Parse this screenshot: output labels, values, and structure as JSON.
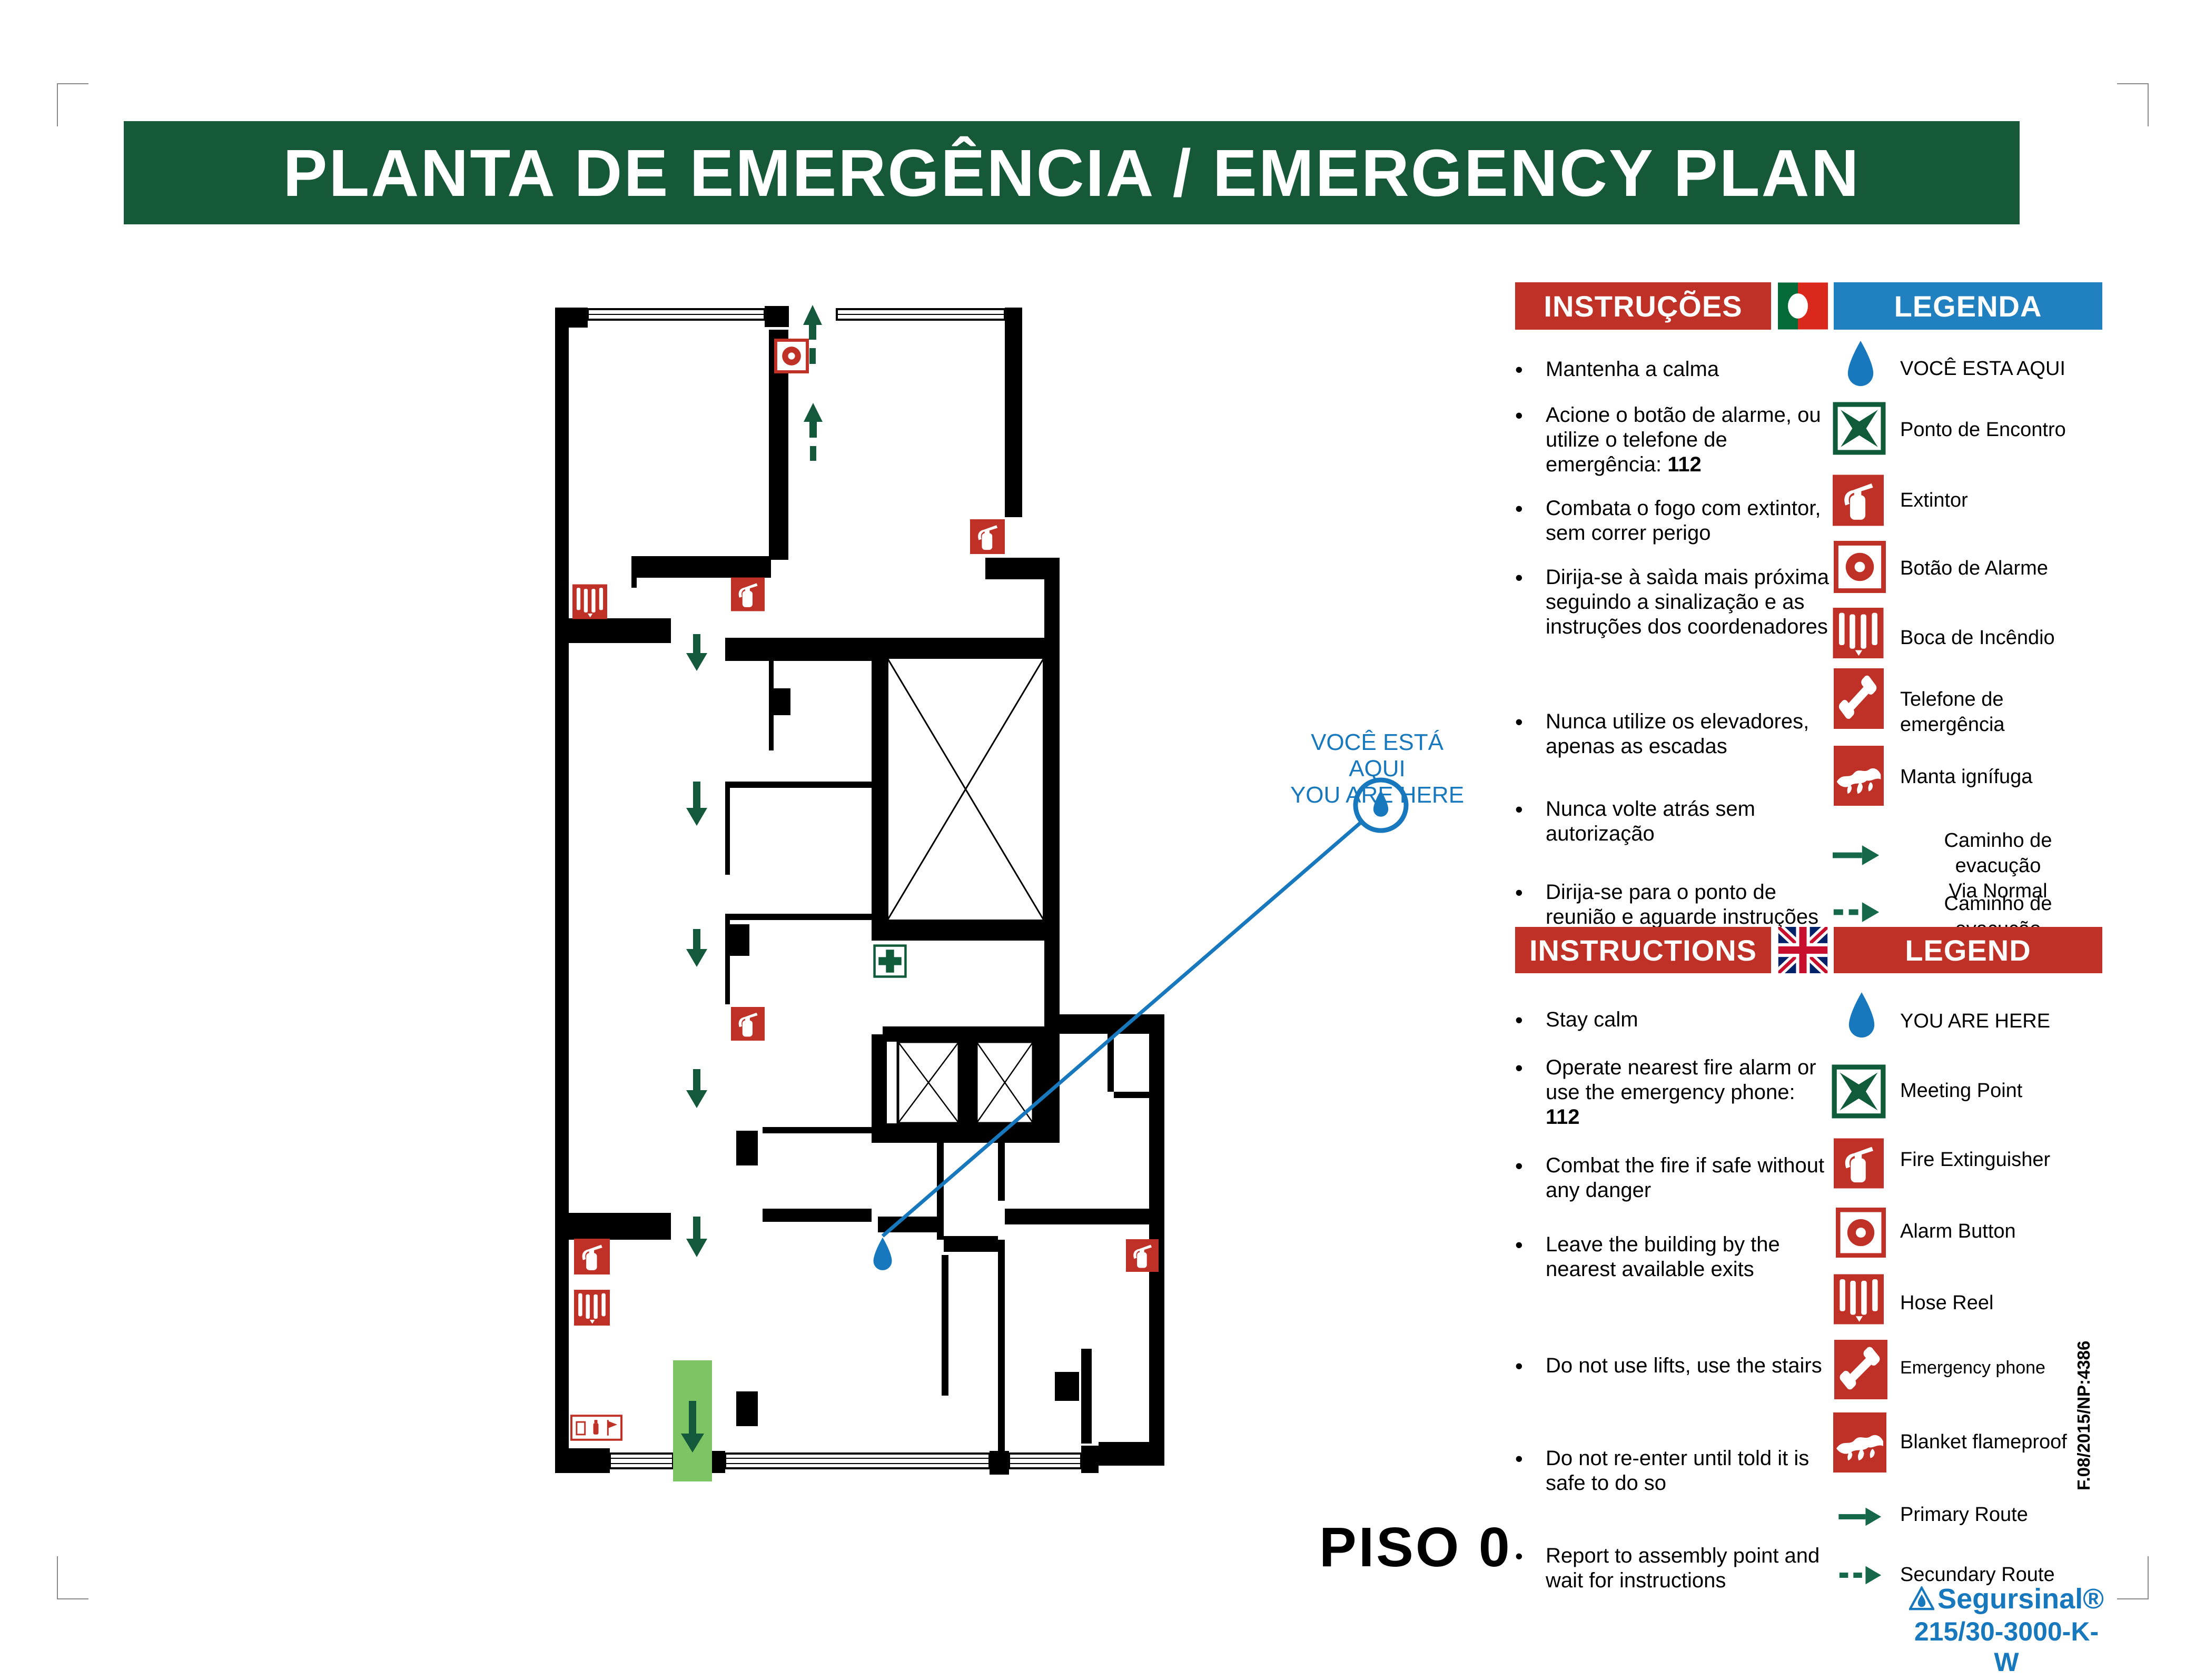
{
  "page": {
    "title": "PLANTA DE EMERGÊNCIA / EMERGENCY PLAN",
    "floor_label": "PISO 0"
  },
  "callout": {
    "line1": "VOCÊ ESTÁ AQUI",
    "line2": "YOU ARE HERE"
  },
  "sections": {
    "pt": {
      "instructions_header": "INSTRUÇÕES",
      "legend_header": "LEGENDA",
      "flag": "portugal-flag",
      "instructions": [
        {
          "text": "Mantenha a calma"
        },
        {
          "pre": "Acione o botão de alarme, ou utilize o telefone de emergência: ",
          "strong": "112"
        },
        {
          "text": "Combata o fogo com extintor, sem correr perigo"
        },
        {
          "text": "Dirija-se à saìda mais próxima seguindo a sinalização e as instruções dos coordenadores"
        },
        {
          "text": "Nunca utilize os elevadores, apenas as escadas"
        },
        {
          "text": "Nunca volte atrás sem autorização"
        },
        {
          "text": "Dirija-se para o ponto de reunião e aguarde instruções"
        }
      ],
      "legend": [
        {
          "icon": "you-are-here-drop-icon",
          "label": "VOCÊ ESTA AQUI"
        },
        {
          "icon": "meeting-point-icon",
          "label": "Ponto de Encontro"
        },
        {
          "icon": "fire-extinguisher-icon",
          "label": "Extintor"
        },
        {
          "icon": "alarm-button-icon",
          "label": "Botão de Alarme"
        },
        {
          "icon": "hose-reel-icon",
          "label": "Boca de Incêndio"
        },
        {
          "icon": "emergency-phone-icon",
          "label": "Telefone de emergência"
        },
        {
          "icon": "fire-blanket-icon",
          "label": "Manta ignífuga"
        },
        {
          "icon": "primary-route-arrow-icon",
          "label": "Caminho de evacução\nVia Normal"
        },
        {
          "icon": "secondary-route-arrow-icon",
          "label": "Caminho de evacução\nVia Alternativa"
        }
      ]
    },
    "en": {
      "instructions_header": "INSTRUCTIONS",
      "legend_header": "LEGEND",
      "flag": "uk-flag",
      "instructions": [
        {
          "text": "Stay calm"
        },
        {
          "pre": "Operate nearest fire alarm or use the emergency phone: ",
          "strong": "112"
        },
        {
          "text": "Combat the fire if safe without any danger"
        },
        {
          "text": "Leave the building by the nearest available exits"
        },
        {
          "text": "Do not use lifts, use the stairs"
        },
        {
          "text": "Do not re-enter until told it is safe to do so"
        },
        {
          "text": "Report to assembly point and wait for instructions"
        }
      ],
      "legend": [
        {
          "icon": "you-are-here-drop-icon",
          "label": "YOU ARE HERE"
        },
        {
          "icon": "meeting-point-icon",
          "label": "Meeting Point"
        },
        {
          "icon": "fire-extinguisher-icon",
          "label": "Fire Extinguisher"
        },
        {
          "icon": "alarm-button-icon",
          "label": "Alarm Button"
        },
        {
          "icon": "hose-reel-icon",
          "label": "Hose Reel"
        },
        {
          "icon": "emergency-phone-icon",
          "label": "Emergency phone"
        },
        {
          "icon": "fire-blanket-icon",
          "label": "Blanket flameproof"
        },
        {
          "icon": "primary-route-arrow-icon",
          "label": "Primary Route"
        },
        {
          "icon": "secondary-route-arrow-icon",
          "label": "Secundary Route"
        }
      ]
    }
  },
  "footer": {
    "doc_code": "F.08/2015/NP:4386",
    "brand": "Segursinal®",
    "product_code": "215/30-3000-K-W"
  },
  "colors": {
    "title_green": "#155938",
    "banner_red": "#BF3026",
    "banner_blue": "#2080C0",
    "marker_blue": "#1878BE",
    "route_green": "#15694A",
    "exit_light_green": "#7CC464"
  }
}
